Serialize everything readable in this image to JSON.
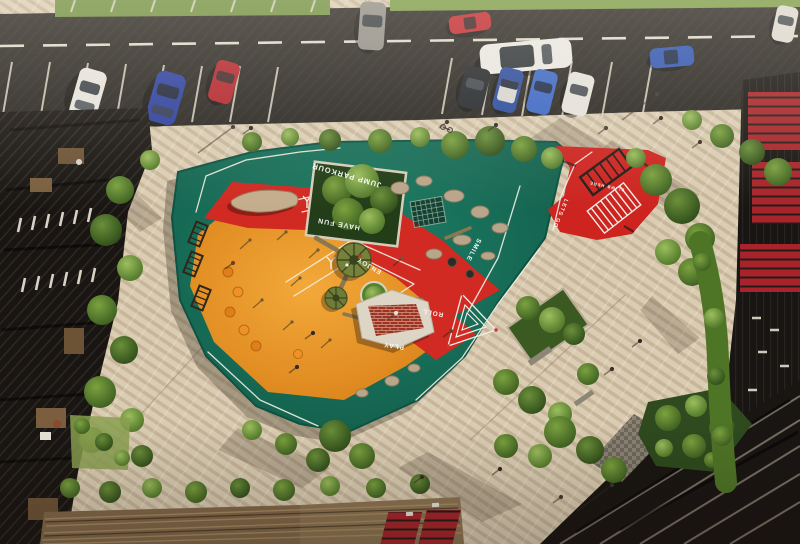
{
  "scene": {
    "type": "aerial-render",
    "description": "Top-down aerial view of an urban pocket park: an angular playground with green, orange and red rubber zones painted with motivational words, rope-climbing carousels, parkour boulders and a brick pavilion, surrounded by a striped paver plaza, trees and hedges, a street with parked cars at top, wooden amphitheater steps at bottom, and dark residential buildings on the left and right."
  },
  "playground": {
    "labels": {
      "jump_parkour": "JUMP PARKOUR",
      "have_fun": "HAVE FUN",
      "enjoy": "ENJOY",
      "smile": "SMILE",
      "roll": "ROLL",
      "play": "PLAY",
      "lets_go": "LETS GO",
      "climb_here": "CLIMB HERE"
    },
    "zones": [
      {
        "name": "green-zone",
        "color": "#17735c"
      },
      {
        "name": "orange-zone",
        "color": "#e8951f"
      },
      {
        "name": "red-zone",
        "color": "#d02a22"
      },
      {
        "name": "red-parkour-corner",
        "color": "#cd2420"
      }
    ],
    "equipment": [
      "rope climbing carousel",
      "small climbing carousel",
      "tree platform",
      "balance beams",
      "driftwood log sculpture",
      "brick pavilion",
      "parkour boulders",
      "climbing net",
      "monkey bars",
      "rubber domes",
      "triangle spiral marking",
      "parkour ladder marking"
    ]
  },
  "street": {
    "road_color": "#292521",
    "marking_color": "#e3ddcf",
    "vehicles": [
      {
        "name": "white hatchback parked",
        "color": "#e6e3db"
      },
      {
        "name": "blue coupe parked",
        "color": "#2b3f9e"
      },
      {
        "name": "red car parked",
        "color": "#b2242a"
      },
      {
        "name": "silver suv parked",
        "color": "#908d86"
      },
      {
        "name": "red car driving",
        "color": "#c1272c"
      },
      {
        "name": "white suv driving",
        "color": "#e9e7e1"
      },
      {
        "name": "blue sedan driving",
        "color": "#2e52b0"
      },
      {
        "name": "dark suv parked",
        "color": "#23252a"
      },
      {
        "name": "blue car parked",
        "color": "#2a4a9c"
      },
      {
        "name": "light blue car parked",
        "color": "#3b66c4"
      },
      {
        "name": "white car parked",
        "color": "#e4e1da"
      },
      {
        "name": "white car corner",
        "color": "#dcd8cf"
      }
    ]
  },
  "plaza": {
    "paving_color": "#dbcdb4",
    "stripe_color": "#c8b89c"
  },
  "landscape": {
    "tree_dark": "#3f6222",
    "tree_light": "#86ab4e",
    "hedge": "#557c2c",
    "grass": "#6f8f3f"
  },
  "buildings": {
    "facade_dark": "#191512",
    "red_accent": "#a3242b",
    "steps_wood": "#82684a",
    "awning_red": "#b3262b"
  }
}
